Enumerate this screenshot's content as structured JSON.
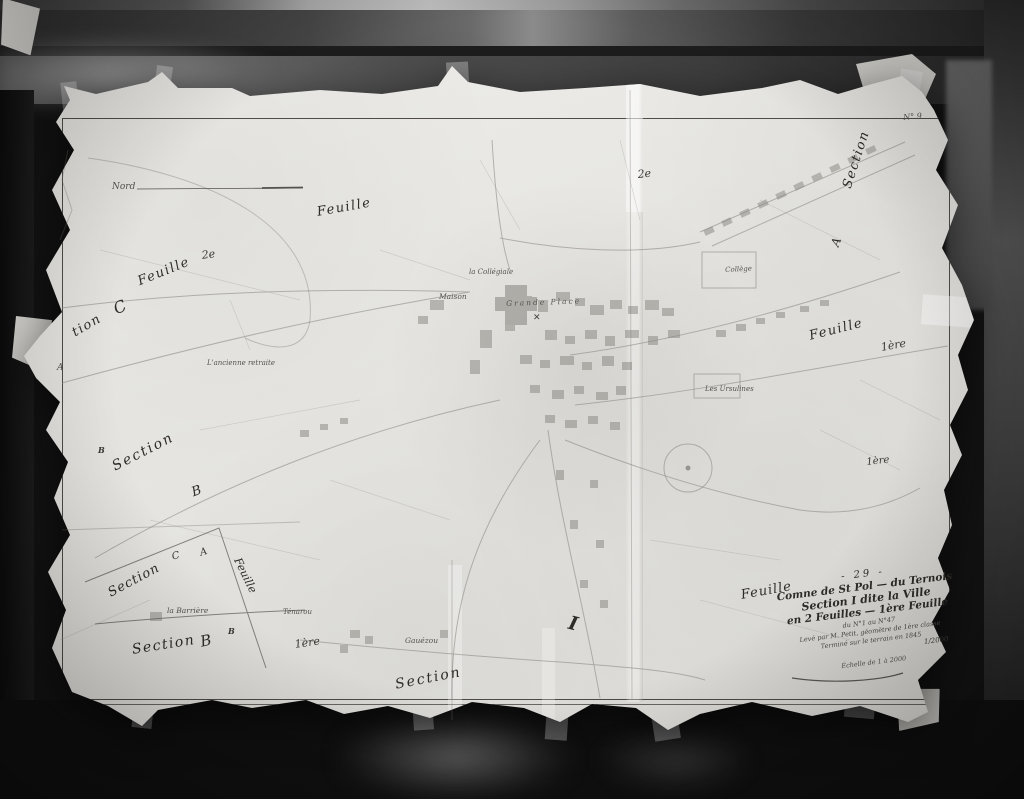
{
  "palette": {
    "backdrop": "#141414",
    "paper": "#e9e8e4",
    "ink": "#3b3934",
    "faint_line": "#8d8b85"
  },
  "labels": [
    {
      "text": "Nord"
    },
    {
      "text": "Feuille"
    },
    {
      "text": "2e"
    },
    {
      "text": "Feuille"
    },
    {
      "text": "C"
    },
    {
      "text": "tion"
    },
    {
      "text": "A"
    },
    {
      "text": "L'ancienne retraite"
    },
    {
      "text": "la Collégiale"
    },
    {
      "text": "Maison"
    },
    {
      "text": "Grande Place"
    },
    {
      "text": "Collège"
    },
    {
      "text": "Section"
    },
    {
      "text": "A"
    },
    {
      "text": "Feuille"
    },
    {
      "text": "1ère"
    },
    {
      "text": "Les Ursulines"
    },
    {
      "text": "B"
    },
    {
      "text": "Section"
    },
    {
      "text": "B"
    },
    {
      "text": "1ère"
    },
    {
      "text": "2e"
    },
    {
      "text": "C"
    },
    {
      "text": "A"
    },
    {
      "text": "Section"
    },
    {
      "text": "Feuille"
    },
    {
      "text": "la Barrière"
    },
    {
      "text": "B"
    },
    {
      "text": "Section"
    },
    {
      "text": "B"
    },
    {
      "text": "Ténarou"
    },
    {
      "text": "1ère"
    },
    {
      "text": "Gauézou"
    },
    {
      "text": "Section"
    },
    {
      "text": "I"
    },
    {
      "text": "Feuille"
    },
    {
      "text": "N° 9"
    }
  ],
  "title_block": {
    "plate_number": "- 29 -",
    "commune_line": "Comne de St Pol — du Ternois",
    "section_line": "Section I dite la Ville",
    "feuilles_line": "en 2 Feuilles — 1ère Feuille",
    "numbers_line": "du N°1 au N°47",
    "surveyor_line": "Levé par M. Petit, géomètre de 1ère classe",
    "date_line": "Terminé sur le terrain en 1845",
    "scale_fraction": "1/2000",
    "scale_caption": "Échelle de 1 à 2000"
  },
  "symbols": {
    "windmill_cross": "✕"
  }
}
